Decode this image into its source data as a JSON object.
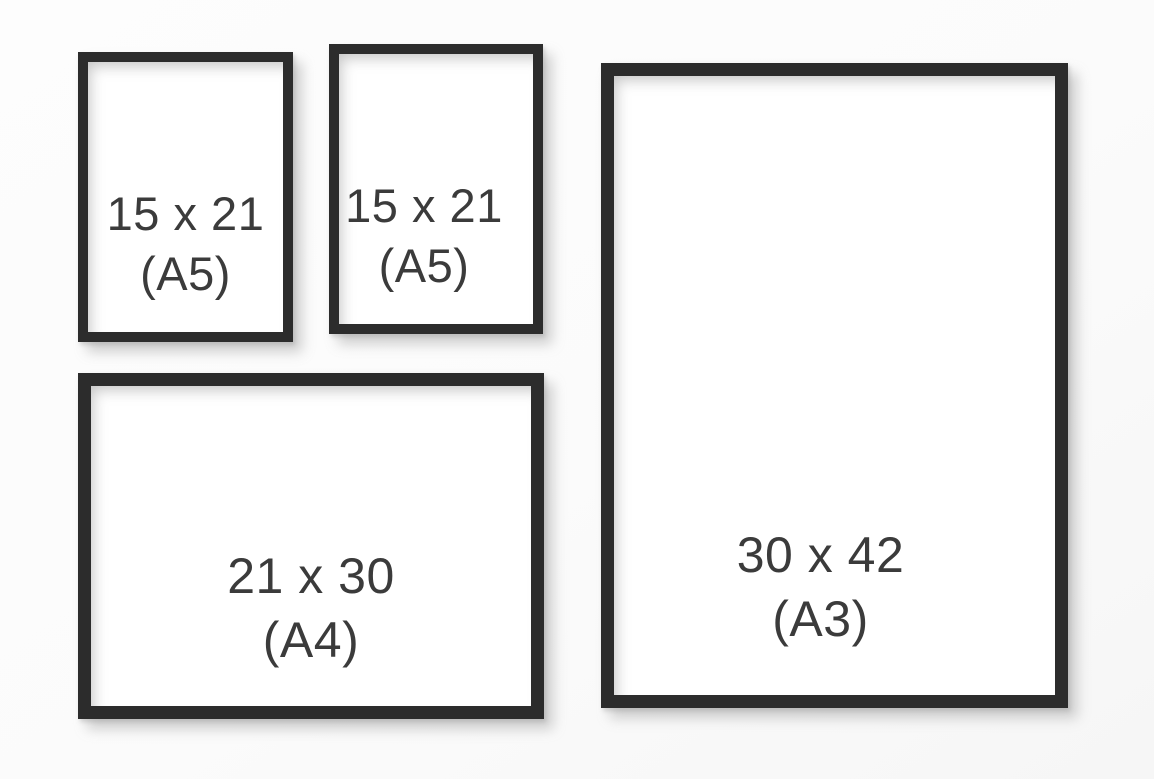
{
  "canvas": {
    "width": 1154,
    "height": 779,
    "background": "#fbfbfb"
  },
  "colors": {
    "frame_border": "#2c2c2c",
    "frame_fill": "#ffffff",
    "label_text": "#3b3b3b",
    "shadow": "#8c8c8c"
  },
  "frames": [
    {
      "id": "a5-top-left",
      "orientation": "portrait",
      "size": "15 x 21",
      "format": "(A5)"
    },
    {
      "id": "a5-top-middle",
      "orientation": "portrait",
      "size": "15 x 21",
      "format": "(A5)"
    },
    {
      "id": "a4-bottom-left",
      "orientation": "landscape",
      "size": "21 x 30",
      "format": "(A4)"
    },
    {
      "id": "a3-right",
      "orientation": "portrait",
      "size": "30 x 42",
      "format": "(A3)"
    }
  ]
}
